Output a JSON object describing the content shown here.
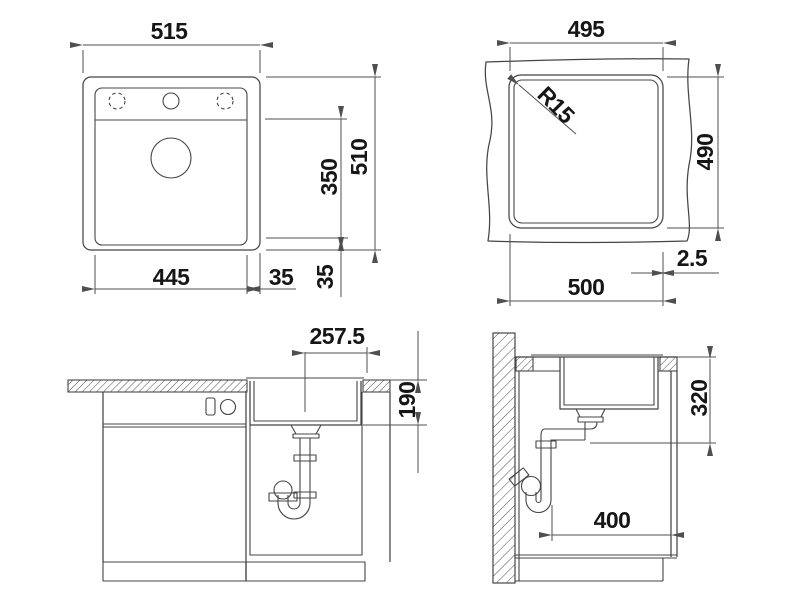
{
  "drawing": {
    "top_view": {
      "overall_width": "515",
      "overall_depth": "510",
      "bowl_width": "445",
      "bowl_depth": "350",
      "edge_right": "35",
      "edge_bottom": "35"
    },
    "cutout_view": {
      "cutout_width": "495",
      "cutout_depth": "490",
      "min_cabinet_width": "500",
      "edge_offset": "2.5",
      "corner_radius": "R15"
    },
    "front_view": {
      "drain_center_offset": "257.5",
      "bowl_inner_depth": "190"
    },
    "side_view": {
      "min_install_height": "320",
      "min_install_depth": "400"
    }
  },
  "colors": {
    "line": "#454545",
    "dimension": "#4f4f4f",
    "text": "#161616",
    "background": "#ffffff"
  }
}
